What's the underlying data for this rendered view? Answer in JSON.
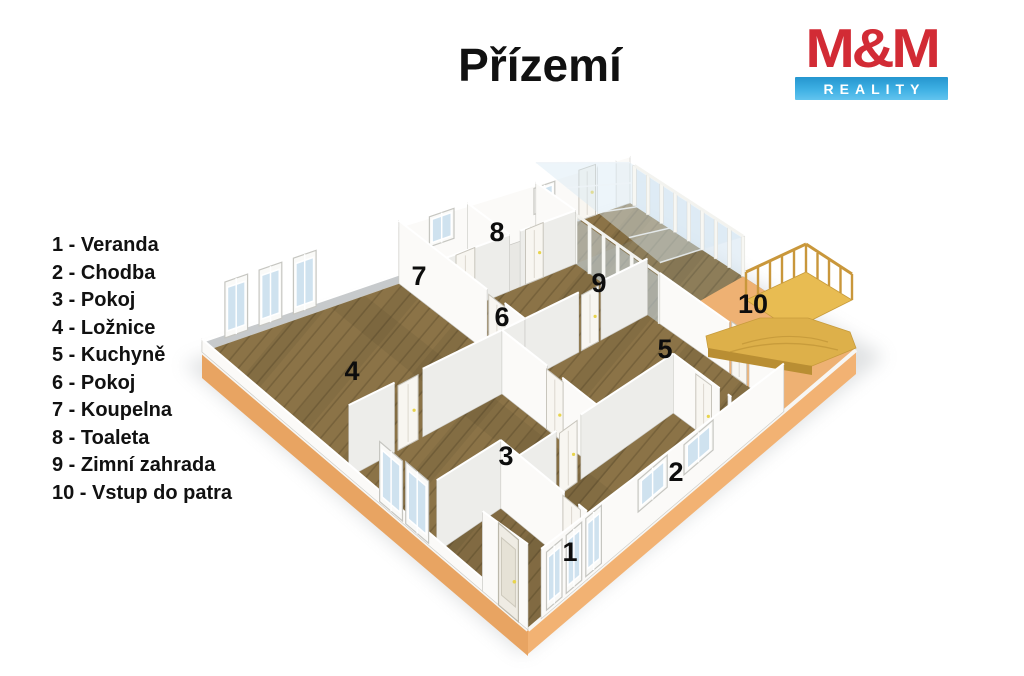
{
  "title": "Přízemí",
  "logo": {
    "text_top": "M&M",
    "text_bottom": "REALITY",
    "red": "#d22b35",
    "blue_top": "#2596cf",
    "blue_bottom": "#62c4ee"
  },
  "legend": {
    "items": [
      {
        "number": "1",
        "name": "Veranda",
        "label": "1 - Veranda"
      },
      {
        "number": "2",
        "name": "Chodba",
        "label": "2 - Chodba"
      },
      {
        "number": "3",
        "name": "Pokoj",
        "label": "3 - Pokoj"
      },
      {
        "number": "4",
        "name": "Ložnice",
        "label": "4 - Ložnice"
      },
      {
        "number": "5",
        "name": "Kuchyně",
        "label": "5 - Kuchyně"
      },
      {
        "number": "6",
        "name": "Pokoj",
        "label": "6 - Pokoj"
      },
      {
        "number": "7",
        "name": "Koupelna",
        "label": "7 - Koupelna"
      },
      {
        "number": "8",
        "name": "Toaleta",
        "label": "8 - Toaleta"
      },
      {
        "number": "9",
        "name": "Zimní zahrada",
        "label": "9 - Zimní zahrada"
      },
      {
        "number": "10",
        "name": "Vstup do patra",
        "label": "10 - Vstup do patra"
      }
    ]
  },
  "plan": {
    "rooms": [
      {
        "number": "1",
        "name": "Veranda"
      },
      {
        "number": "2",
        "name": "Chodba"
      },
      {
        "number": "3",
        "name": "Pokoj"
      },
      {
        "number": "4",
        "name": "Ložnice"
      },
      {
        "number": "5",
        "name": "Kuchyně"
      },
      {
        "number": "6",
        "name": "Pokoj"
      },
      {
        "number": "7",
        "name": "Koupelna"
      },
      {
        "number": "8",
        "name": "Toaleta"
      },
      {
        "number": "9",
        "name": "Zimní zahrada"
      },
      {
        "number": "10",
        "name": "Vstup do patra"
      }
    ]
  },
  "colors": {
    "floor_wood": "#8b7347",
    "floor_seam": "#77623b",
    "bathroom_floor": "#e9e8e4",
    "base_orange": "#e8a462",
    "base_orange_light": "#f2b273",
    "terrace_orange": "#eeb173",
    "wall_white": "#fbfaf8",
    "wall_shade": "#ededea",
    "wall_gray": "#c7cacc",
    "glass": "#cfe2ef",
    "roof_glass": "#d6e8f3",
    "stair_gold": "#e8bc52",
    "stair_gold_dark": "#ddb04a",
    "stair_rail": "#c9973b",
    "number_color": "#0d0d0d"
  }
}
